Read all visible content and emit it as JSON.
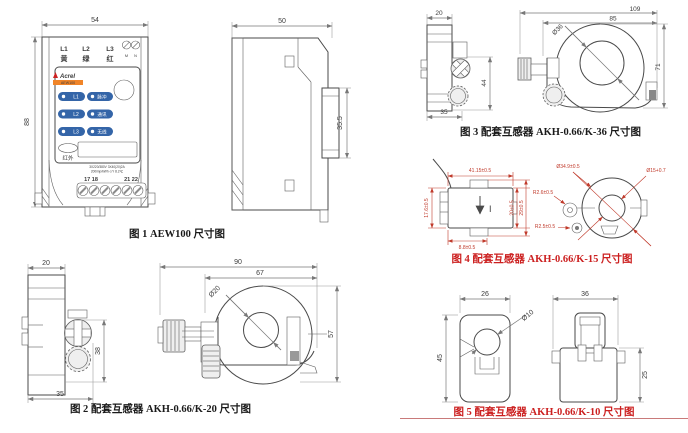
{
  "colors": {
    "line": "#4a4a4a",
    "dim_gray": "#787878",
    "dim_red": "#c03a2b",
    "caption_red": "#cc2020",
    "led_blue": "#3465a8",
    "brand_red": "#cc2222",
    "banner_orange": "#f08428"
  },
  "fig1": {
    "caption": "图 1 AEW100 尺寸图",
    "dim_width": "54",
    "dim_height": "88",
    "side_dim_width": "50",
    "side_dim_rail": "35.5",
    "phase1": "L1",
    "phase2": "L2",
    "phase3": "L3",
    "color1": "黄",
    "color2": "绿",
    "color3": "红",
    "term_m": "M",
    "term_n": "N",
    "brand": "Acrel",
    "model": "AEW100",
    "led1": "L1",
    "led1_tag": "脉冲",
    "led2": "L2",
    "led2_tag": "通讯",
    "led3": "L3",
    "led3_tag": "无线",
    "infrared": "红外",
    "spec1": "3X220/380V 3X40(20)2A",
    "spec2": "200imp/kWh ⊙Y 8.2℃",
    "terms_left": "17 18",
    "terms_right": "21 22"
  },
  "fig2": {
    "caption": "图 2 配套互感器 AKH-0.66/K-20 尺寸图",
    "dim_top": "20",
    "dim_bottom": "35",
    "dim_height": "38",
    "dim_outer_w": "90",
    "dim_inner_w": "67",
    "dim_hole": "Ø20",
    "dim_right_h": "57"
  },
  "fig3": {
    "caption": "图 3 配套互感器 AKH-0.66/K-36 尺寸图",
    "dim_top": "20",
    "dim_bottom": "35",
    "dim_height": "44",
    "dim_outer_w": "109",
    "dim_inner_w": "85",
    "dim_hole": "Ø36",
    "dim_right_h": "71"
  },
  "fig4": {
    "caption": "图 4 配套互感器 AKH-0.66/K-15 尺寸图",
    "dim_top": "41.15±0.5",
    "dim_left": "17.6±0.5",
    "dim_bottom": "8.8±0.5",
    "dim_inner_h": "20±0.5",
    "dim_outer_h": "29±0.5",
    "dim_outer_d": "Ø34.9±0.5",
    "dim_hole_d": "Ø15+0.7",
    "dim_r1": "R2.6±0.5",
    "dim_r2": "R2.5±0.5",
    "current_mark": "I"
  },
  "fig5": {
    "caption": "图 5 配套互感器 AKH-0.66/K-10 尺寸图",
    "dim_w_left": "26",
    "dim_h_left": "45",
    "dim_hole": "Ø10",
    "dim_w_right": "36",
    "dim_h_right": "25"
  }
}
